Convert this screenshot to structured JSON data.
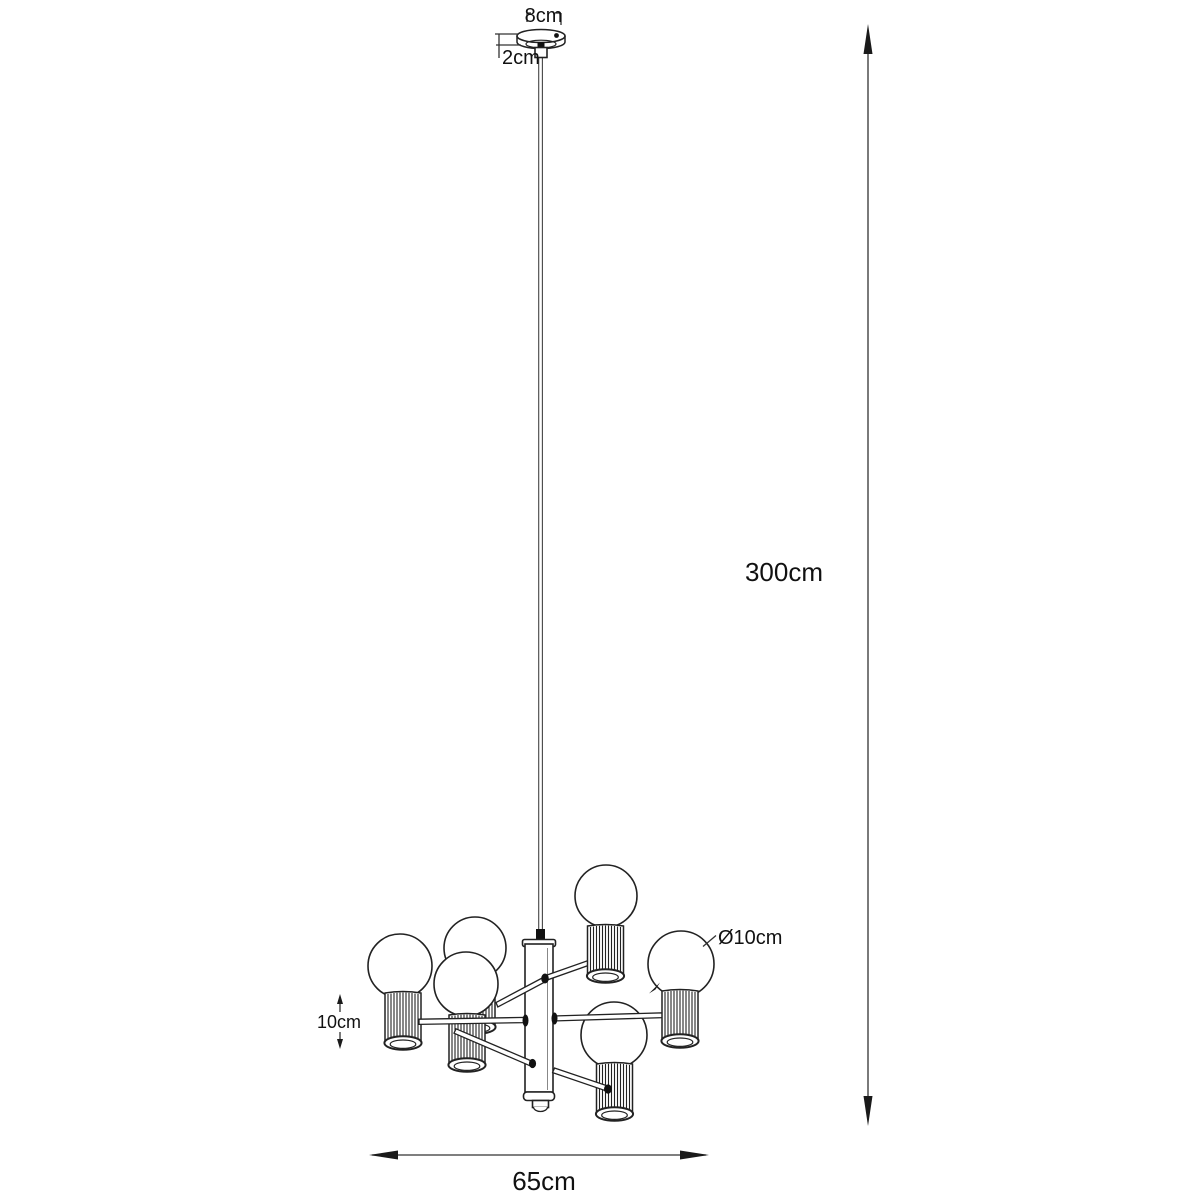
{
  "diagram": {
    "type": "pendant-lamp-dimension-drawing",
    "background_color": "#ffffff",
    "line_color": "#222222",
    "labels": {
      "canopy_width": "8cm",
      "canopy_height": "2cm",
      "suspension_height": "300cm",
      "bulb_diameter": "Ø10cm",
      "shade_height": "10cm",
      "fixture_width": "65cm"
    }
  }
}
